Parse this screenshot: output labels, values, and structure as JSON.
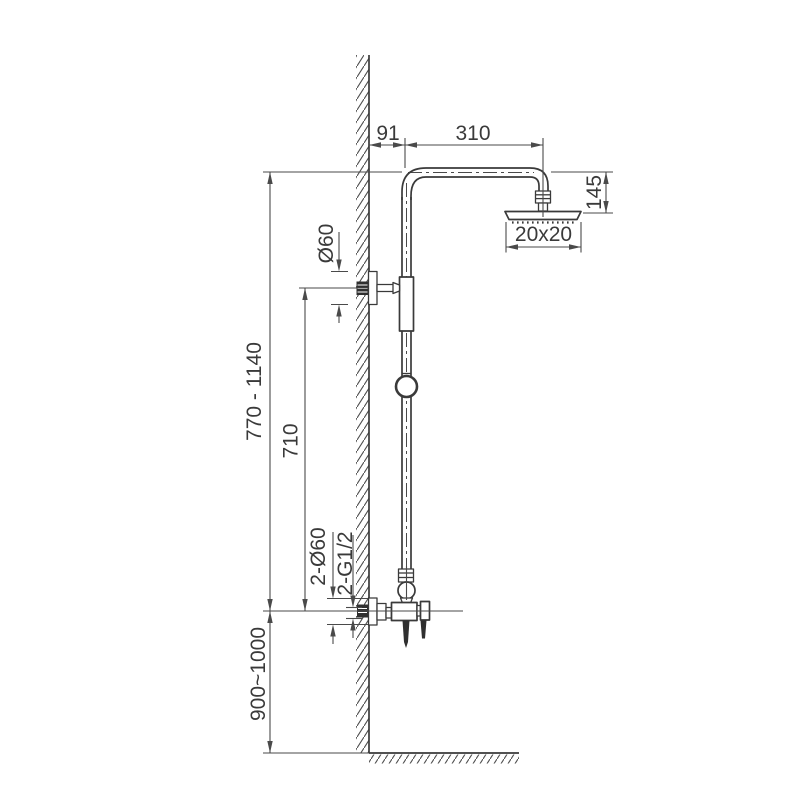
{
  "diagram": {
    "labels": {
      "arm_offset": "91",
      "arm_length": "310",
      "head_drop": "145",
      "head_size": "20x20",
      "bracket_diameter": "Ø60",
      "riser_height_range": "770 - 1140",
      "bracket_to_mixer": "710",
      "flange_diameter": "2-Ø60",
      "connection_thread": "2-G1/2",
      "mixer_install_height": "900~1000"
    },
    "colors": {
      "line": "#3a3a3a",
      "dimension": "#4a4a4a",
      "background": "#ffffff"
    }
  }
}
